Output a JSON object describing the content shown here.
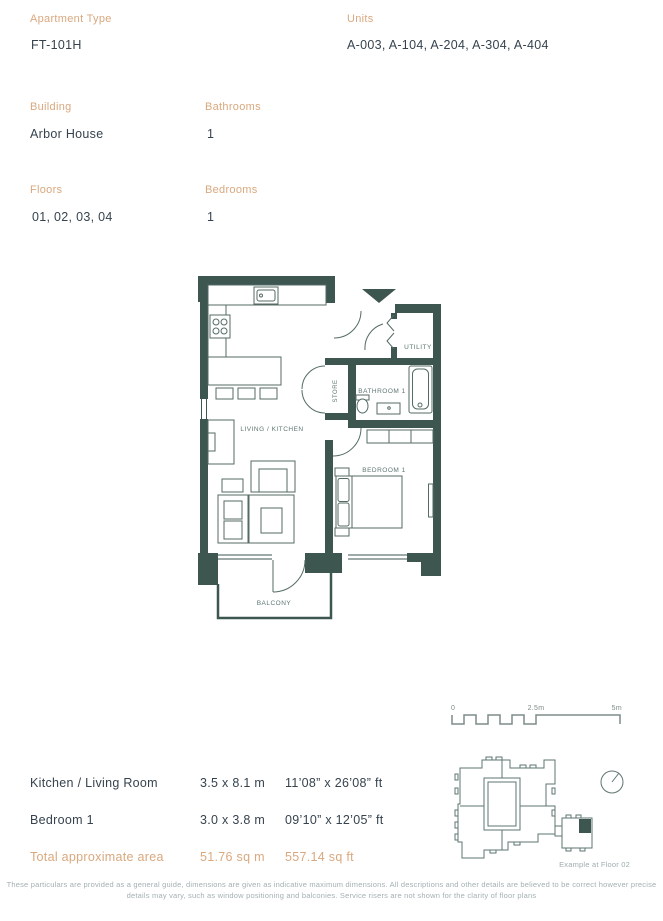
{
  "header": {
    "apartment_type": {
      "label": "Apartment Type",
      "value": "FT-101H"
    },
    "units": {
      "label": "Units",
      "value": "A-003, A-104, A-204, A-304, A-404"
    },
    "building": {
      "label": "Building",
      "value": "Arbor House"
    },
    "bathrooms": {
      "label": "Bathrooms",
      "value": "1"
    },
    "floors": {
      "label": "Floors",
      "value": "01, 02, 03, 04"
    },
    "bedrooms": {
      "label": "Bedrooms",
      "value": "1"
    }
  },
  "floorplan": {
    "rooms": {
      "living_kitchen": "LIVING / KITCHEN",
      "store": "STORE",
      "bathroom": "BATHROOM 1",
      "utility": "UTILITY",
      "bedroom": "BEDROOM 1",
      "balcony": "BALCONY"
    }
  },
  "scale_bar": {
    "start": "0",
    "mid": "2.5m",
    "end": "5m"
  },
  "site_plan": {
    "caption": "Example at Floor 02"
  },
  "dimensions_table": {
    "rows": [
      {
        "name": "Kitchen / Living Room",
        "metric": "3.5 x 8.1 m",
        "imperial": "11’08” x 26’08” ft"
      },
      {
        "name": "Bedroom 1",
        "metric": "3.0 x 3.8 m",
        "imperial": "09’10” x 12’05” ft"
      }
    ],
    "total": {
      "name": "Total approximate area",
      "metric": "51.76 sq m",
      "imperial": "557.14 sq ft"
    }
  },
  "disclaimer": "These particulars are provided as a general guide, dimensions are given as indicative maximum dimensions. All descriptions and other details are believed to be correct however precise details may vary, such as window positioning and balconies. Service risers are not shown for the clarity of floor plans",
  "colors": {
    "accent": "#D9A87E",
    "dark_text": "#36434E",
    "wall": "#3D5650",
    "plan_label": "#5E7672",
    "muted_text": "#A3B0B3"
  }
}
